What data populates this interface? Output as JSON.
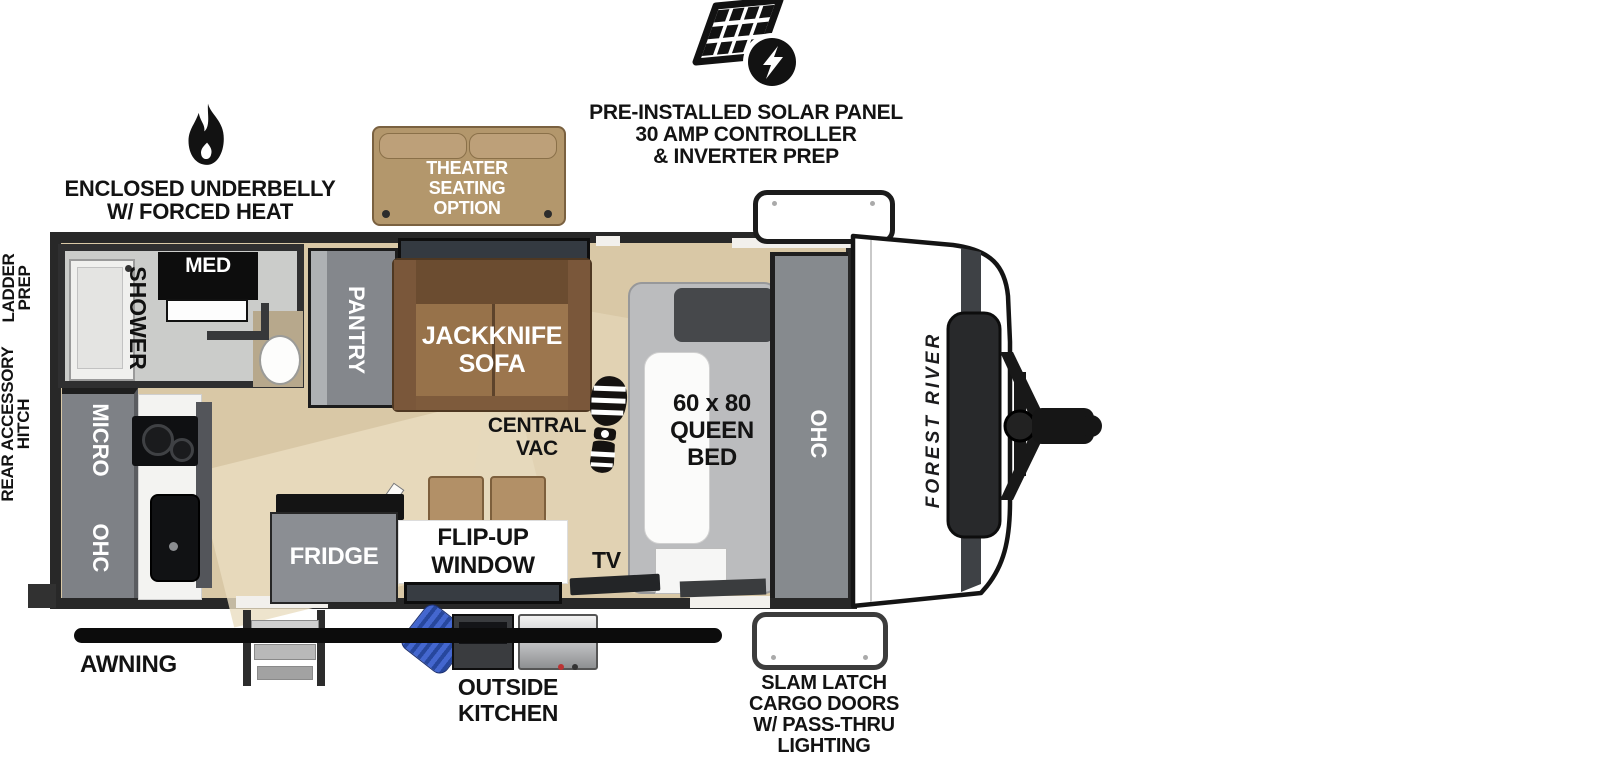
{
  "brand": "FOREST RIVER",
  "exterior": {
    "solar_lines": [
      "PRE-INSTALLED SOLAR PANEL",
      "30 AMP CONTROLLER",
      "& INVERTER PREP"
    ],
    "underbelly_lines": [
      "ENCLOSED UNDERBELLY",
      "W/ FORCED HEAT"
    ],
    "theater_lines": [
      "THEATER",
      "SEATING",
      "OPTION"
    ],
    "ladder_lines": [
      "LADDER",
      "PREP"
    ],
    "rear_hitch_lines": [
      "REAR ACCESSORY",
      "HITCH"
    ],
    "awning": "AWNING",
    "outside_kitchen_lines": [
      "OUTSIDE",
      "KITCHEN"
    ],
    "cargo_lines": [
      "SLAM LATCH",
      "CARGO DOORS",
      "W/ PASS-THRU",
      "LIGHTING"
    ]
  },
  "interior": {
    "shower": "SHOWER",
    "med": "MED",
    "pantry": "PANTRY",
    "sofa_lines": [
      "JACKKNIFE",
      "SOFA"
    ],
    "central_vac_lines": [
      "CENTRAL",
      "VAC"
    ],
    "bed_lines": [
      "60 x 80",
      "QUEEN",
      "BED"
    ],
    "wardrobe_ohc": "OHC",
    "micro": "MICRO",
    "kitchen_ohc": "OHC",
    "fridge": "FRIDGE",
    "flip_window_lines": [
      "FLIP-UP",
      "WINDOW"
    ],
    "tv": "TV"
  },
  "colors": {
    "wall": "#282828",
    "floor": "#d9c8a6",
    "cabinet_gray": "#84878c",
    "sofa_brown": "#8f6b45",
    "theater_tan": "#b3976c",
    "hose_blue": "#3f66c9"
  }
}
